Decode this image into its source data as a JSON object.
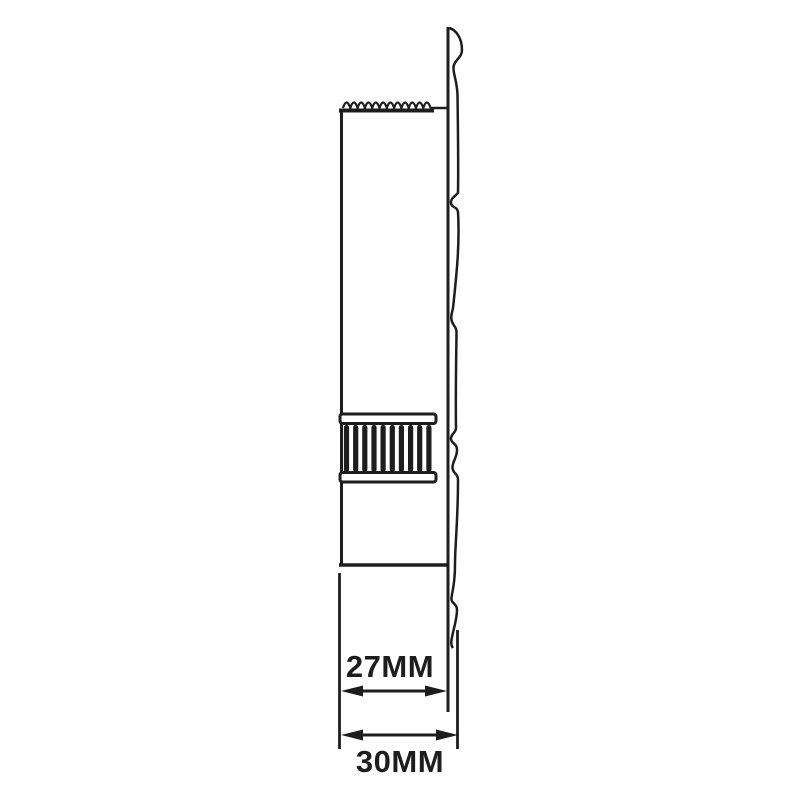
{
  "page": {
    "background_color": "#ffffff"
  },
  "drawing": {
    "kind": "technical line drawing of a pole/tube inserted in a larger tube, side section view",
    "line_color": "#1d1d1d",
    "labels": {
      "inner_diameter": "27MM",
      "outer_diameter": "30MM"
    },
    "dimensions": [
      {
        "name": "inner tube width",
        "value": "27MM"
      },
      {
        "name": "outer tube width",
        "value": "30MM"
      }
    ]
  }
}
